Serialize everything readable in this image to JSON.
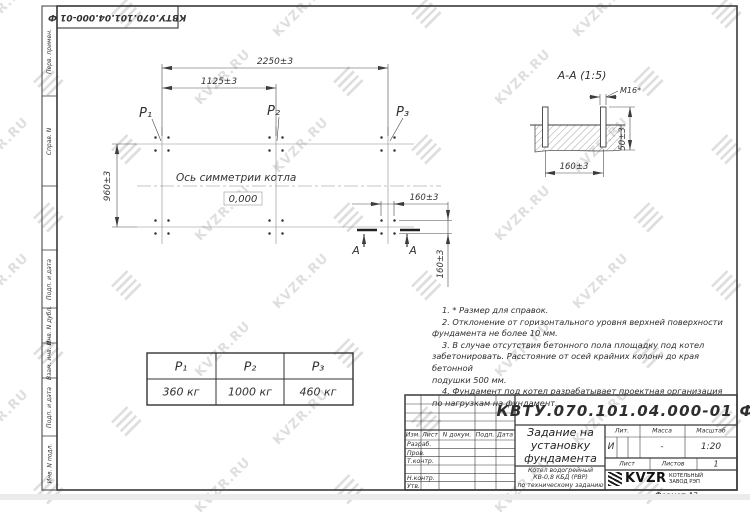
{
  "watermark": {
    "text": "KVZR.RU"
  },
  "stamp_top": "КВТУ.070.101.04.000-01 Ф",
  "side_labels": {
    "perv": "Перв. примен.",
    "sprav": "Справ. N",
    "podp1": "Подп. и дата",
    "inv_dubl": "Инв. N дубл.",
    "vzam": "Взам. инв. N",
    "podp2": "Подп. и дата",
    "inv_podl": "Инв. N подл."
  },
  "plan": {
    "dim_width_total": "2250±3",
    "dim_width_half": "1125±3",
    "dim_height": "960±3",
    "dim_bolt_x": "160±3",
    "dim_bolt_y": "160±3",
    "p1": "P₁",
    "p2": "P₂",
    "p3": "P₃",
    "axis_label": "Ось симметрии котла",
    "level": "0,000",
    "section_mark": "A"
  },
  "section": {
    "title": "А-А (1:5)",
    "bolt": "M16*",
    "dim_height": "50±3",
    "dim_width": "160±3"
  },
  "notes": {
    "lines": [
      "1. * Размер для справок.",
      "2. Отклонение от горизонтального уровня верхней поверхности",
      "фундамента не более 10 мм.",
      "3. В случае отсутствия бетонного пола площадку под котел",
      "забетонировать. Расстояние от осей крайних колонн до края бетонной",
      "подушки 500 мм.",
      "4. Фундамент под котел разрабатывает проектная организация",
      "по нагрузкам на фундамент."
    ]
  },
  "load_table": {
    "headers": [
      "P₁",
      "P₂",
      "P₃"
    ],
    "values": [
      "360 кг",
      "1000 кг",
      "460 кг"
    ]
  },
  "title_block": {
    "doc_number": "КВТУ.070.101.04.000-01 Ф",
    "title_lines": [
      "Задание на",
      "установку",
      "фундамента"
    ],
    "subtitle_lines": [
      "Котел водогрейный",
      "КВ-0,8 КБД (РВР)",
      "по техническому заданию"
    ],
    "cols": {
      "izm": "Изм.",
      "list": "Лист",
      "n_dokum": "N докум.",
      "podp": "Подп.",
      "data": "Дата"
    },
    "rows": {
      "razrab": "Разраб.",
      "prov": "Пров.",
      "tkontr": "Т.контр.",
      "nkontr": "Н.контр.",
      "utv": "Утв."
    },
    "lit_label": "Лит.",
    "massa_label": "Масса",
    "masshtab_label": "Масштаб",
    "lit_value": "И",
    "massa_value": "-",
    "masshtab_value": "1:20",
    "list_label": "Лист",
    "listov_label": "Листов",
    "listov_value": "1",
    "company": {
      "logo_text": "KVZR",
      "name_line1": "КОТЕЛЬНЫЙ",
      "name_line2": "ЗАВОД РЭП"
    },
    "format": "Формат А3"
  }
}
